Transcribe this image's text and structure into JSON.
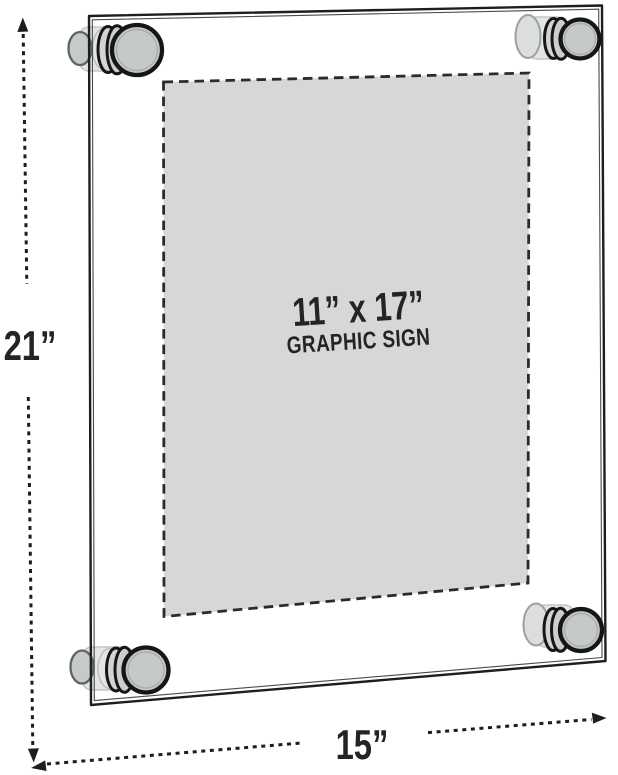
{
  "labels": {
    "height": "21”",
    "width": "15”"
  },
  "sign": {
    "size": "11” x 17”",
    "name": "GRAPHIC SIGN"
  },
  "colors": {
    "background": "#ffffff",
    "outline": "#1e1e1e",
    "dimension_line": "#1d1d1d",
    "label_text": "#242424",
    "sign_fill": "#d6d8d8",
    "sign_border": "#2b2b2b",
    "standoff_fill": "#c6c9c9"
  }
}
